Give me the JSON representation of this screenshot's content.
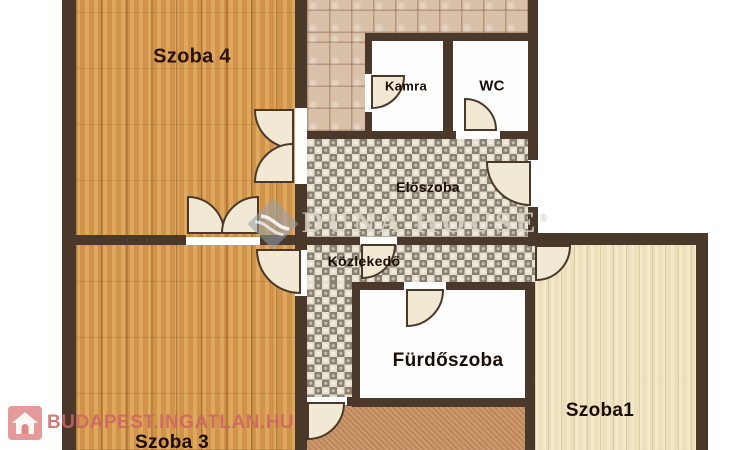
{
  "plan": {
    "title": "apartment floor plan",
    "rooms": {
      "szoba4": {
        "label": "Szoba 4",
        "floor": "warm wood"
      },
      "szoba3": {
        "label": "Szoba 3",
        "floor": "warm wood"
      },
      "szoba1": {
        "label": "Szoba1",
        "floor": "pale wood"
      },
      "kamra": {
        "label": "Kamra",
        "floor": "white"
      },
      "wc": {
        "label": "WC",
        "floor": "white"
      },
      "eloszoba": {
        "label": "Előszoba",
        "floor": "checkered tile"
      },
      "kozlekedo": {
        "label": "Közlekedő",
        "floor": "checkered tile"
      },
      "furdoszoba": {
        "label": "Fürdőszoba",
        "floor": "white"
      },
      "konyha_area": {
        "label": "",
        "floor": "pink ceramic tile, label cut off at top"
      }
    },
    "colors": {
      "wall": "#4a392b",
      "wood_warm": "#d69a4f",
      "wood_pale": "#ece0bc",
      "tile": "#d9c1a9",
      "checker_dark": "#87806f",
      "checker_light": "#e7e0d0",
      "carpet": "#cb9061",
      "room_white": "#fdfdfd",
      "door": "#f2e9d4",
      "portal_red": "#ce6363"
    },
    "watermarks": {
      "duna": {
        "text": "DUNA HOUSE",
        "registered": "®",
        "icon": "duna-house-diamond-icon"
      },
      "portal": {
        "text": "BUDAPEST.INGATLAN.HU",
        "icon": "house-icon"
      }
    }
  }
}
